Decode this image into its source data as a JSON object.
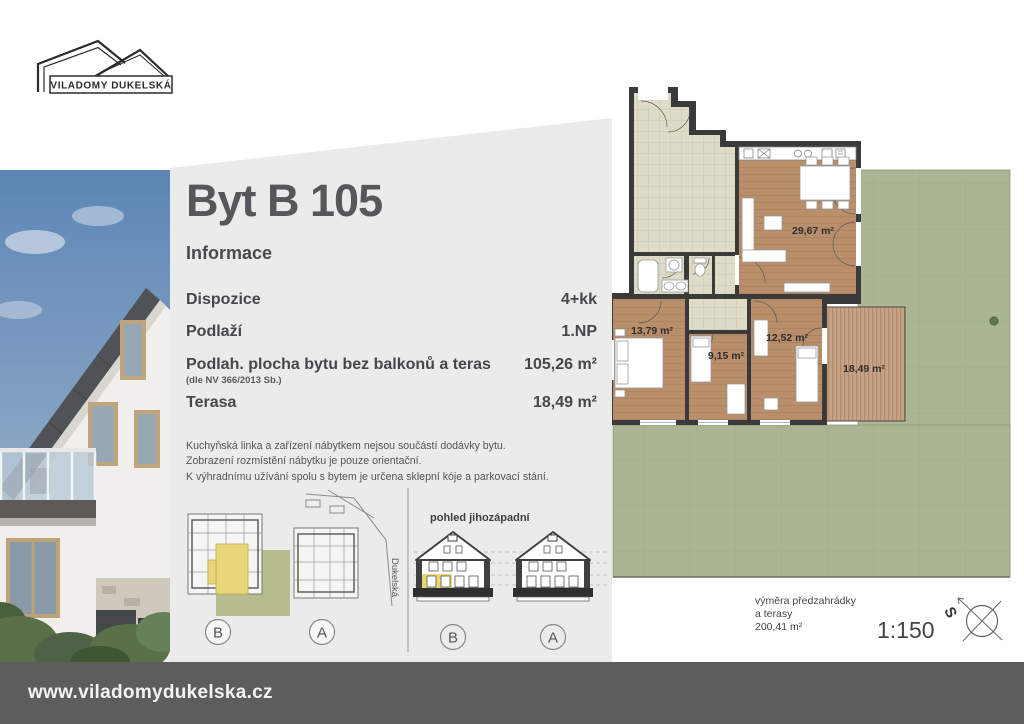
{
  "logo": {
    "name": "VILADOMY DUKELSKÁ"
  },
  "info_panel": {
    "title": "Byt B 105",
    "section_label": "Informace",
    "rows": [
      {
        "label": "Dispozice",
        "value": "4+kk"
      },
      {
        "label": "Podlaží",
        "value": "1.NP"
      },
      {
        "label": "Podlah. plocha bytu bez balkonů a teras",
        "sublabel": "(dle NV 366/2013 Sb.)",
        "value": "105,26 m²"
      },
      {
        "label": "Terasa",
        "value": "18,49 m²"
      }
    ],
    "disclaimer": [
      "Kuchyňská linka a zařízení nábytkem nejsou součástí dodávky bytu.",
      "Zobrazení rozmístění nábytku je pouze orientační.",
      "K výhradnímu užívání spolu s bytem je určena sklepní kóje a parkovací stání."
    ]
  },
  "site_plan": {
    "street_label": "Dukelská",
    "building_b_marker": "B",
    "building_a_marker": "A"
  },
  "elevation": {
    "title": "pohled jihozápadní",
    "building_b_marker": "B",
    "building_a_marker": "A"
  },
  "floor_plan": {
    "living_area": "29,67 m²",
    "bedroom1_area": "13,79 m²",
    "bedroom2_area": "9,15 m²",
    "bedroom3_area": "12,52 m²",
    "terrace_area": "18,49 m²",
    "garden_note_line1": "výměra předzahrádky",
    "garden_note_line2": "a terasy",
    "garden_note_line3": "200,41 m²",
    "scale": "1:150",
    "north_letter": "S"
  },
  "footer": {
    "url": "www.viladomydukelska.cz"
  },
  "colors": {
    "panel_gray": "#ebebeb",
    "footer_gray": "#5d5d5b",
    "lawn_green": "#a9b593",
    "wood_floor": "#b98e6a",
    "deck_wood": "#c7a287",
    "tile_beige": "#dedcc7",
    "highlight_yellow": "#e9d678",
    "wall_dark": "#3a3a3a"
  }
}
